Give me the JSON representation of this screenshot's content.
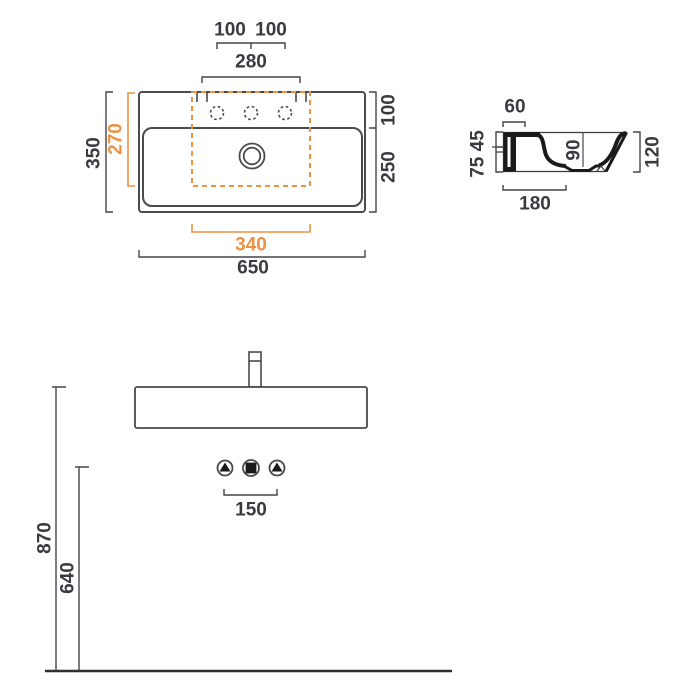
{
  "drawing": {
    "kind": "washbasin dimension drawing",
    "views": [
      "plan view",
      "side section view",
      "front elevation"
    ]
  },
  "colors": {
    "line": "#4A4A4F",
    "dimension_line": "#45454A",
    "text": "#3A3A41",
    "accent_orange": "#EC9243",
    "section_fill": "#1A1A1A",
    "background": "#FFFFFF"
  },
  "plan": {
    "dim_100_left": "100",
    "dim_100_right": "100",
    "dim_280": "280",
    "dim_350": "350",
    "dim_270": "270",
    "dim_100_deck": "100",
    "dim_250": "250",
    "dim_340": "340",
    "dim_650": "650"
  },
  "section": {
    "dim_60": "60",
    "dim_75_45": "75 45",
    "dim_90": "90",
    "dim_120": "120",
    "dim_180": "180"
  },
  "front": {
    "dim_150": "150",
    "dim_870": "870",
    "dim_640": "640"
  }
}
